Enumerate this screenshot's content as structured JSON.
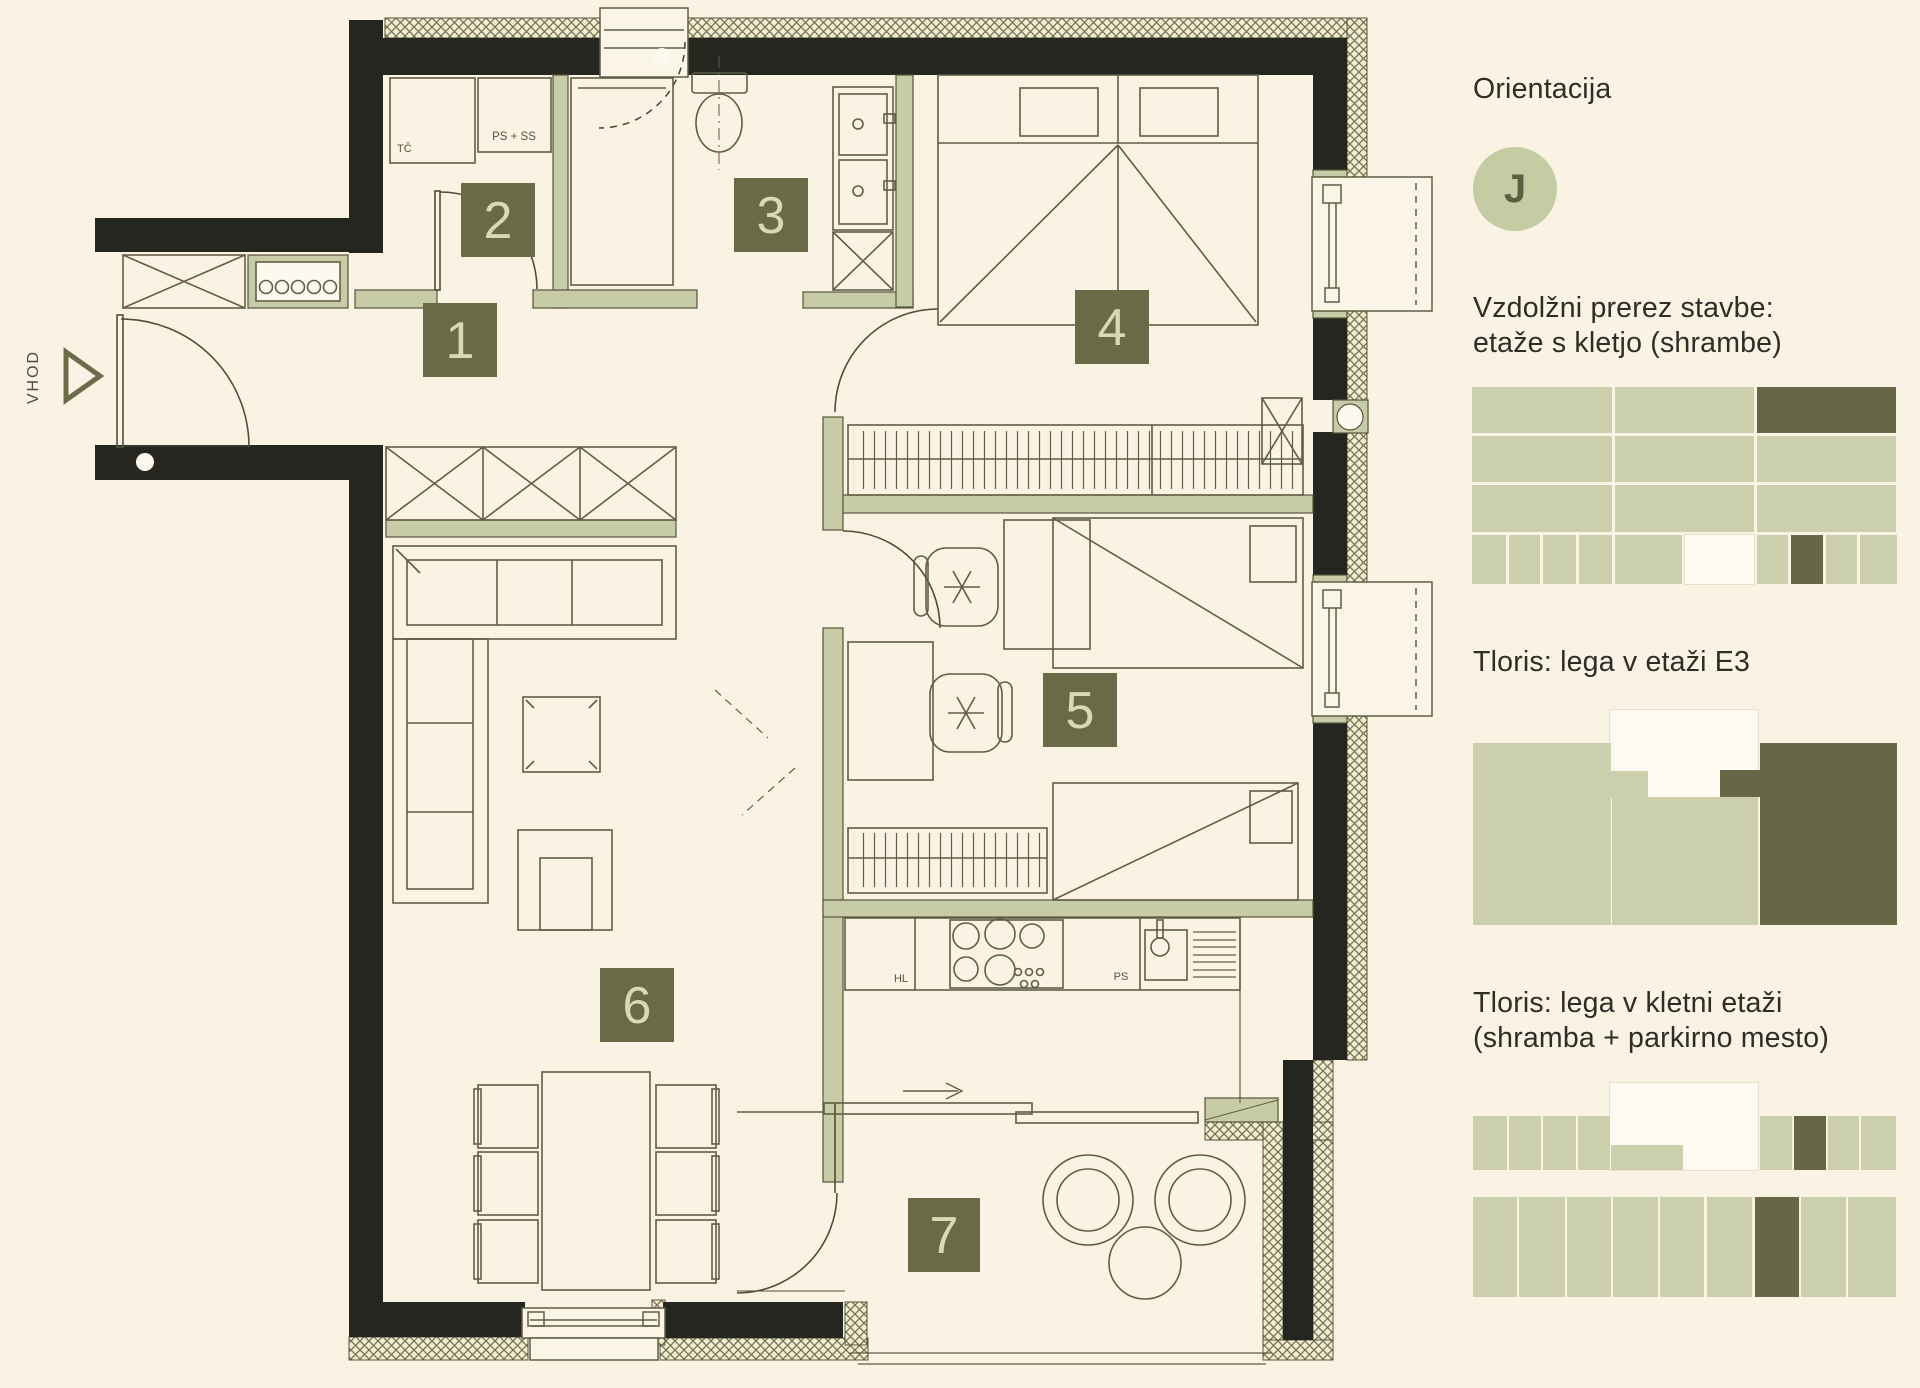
{
  "page": {
    "background": "#faf3e4",
    "colors": {
      "wall": "#262621",
      "line": "#5f5e44",
      "interior_wall": "#c8cca6",
      "badge_bg": "#696b46",
      "badge_text": "#d8dab6",
      "hatch_line": "#74744b",
      "text": "#2d2e28"
    }
  },
  "plan": {
    "entrance_label": "VHOD",
    "badges": [
      "1",
      "2",
      "3",
      "4",
      "5",
      "6",
      "7"
    ],
    "labels": {
      "tc": "TČ",
      "ps_ss": "PS + SS",
      "hl": "HL",
      "ps": "PS"
    }
  },
  "sidebar": {
    "orientation": {
      "title": "Orientacija",
      "value": "J",
      "circle_bg": "#c5cba3",
      "circle_text": "#596041"
    },
    "sections": [
      {
        "title": "Vzdolžni prerez stavbe:\netaže s kletjo (shrambe)"
      },
      {
        "title": "Tloris: lega v etaži E3"
      },
      {
        "title": "Tloris: lega v kletni etaži\n(shramba + parkirno mesto)"
      }
    ],
    "palette": {
      "L": "#cccfac",
      "D": "#666845",
      "W": "#fdfaf1"
    },
    "diagrams": {
      "section_grid": [
        {
          "x": 0,
          "y": 4,
          "w": 140,
          "h": 46,
          "c": "L"
        },
        {
          "x": 143,
          "y": 4,
          "w": 139,
          "h": 46,
          "c": "L"
        },
        {
          "x": 285,
          "y": 4,
          "w": 139,
          "h": 46,
          "c": "D"
        },
        {
          "x": 0,
          "y": 53,
          "w": 140,
          "h": 46,
          "c": "L"
        },
        {
          "x": 143,
          "y": 53,
          "w": 139,
          "h": 46,
          "c": "L"
        },
        {
          "x": 285,
          "y": 53,
          "w": 139,
          "h": 46,
          "c": "L"
        },
        {
          "x": 0,
          "y": 102,
          "w": 140,
          "h": 47,
          "c": "L"
        },
        {
          "x": 143,
          "y": 102,
          "w": 139,
          "h": 47,
          "c": "L"
        },
        {
          "x": 285,
          "y": 102,
          "w": 139,
          "h": 47,
          "c": "L"
        },
        {
          "x": 0,
          "y": 152,
          "w": 34,
          "h": 49,
          "c": "L"
        },
        {
          "x": 37,
          "y": 152,
          "w": 31,
          "h": 49,
          "c": "L"
        },
        {
          "x": 71,
          "y": 152,
          "w": 33,
          "h": 49,
          "c": "L"
        },
        {
          "x": 107,
          "y": 152,
          "w": 33,
          "h": 49,
          "c": "L"
        },
        {
          "x": 143,
          "y": 152,
          "w": 67,
          "h": 49,
          "c": "L"
        },
        {
          "x": 213,
          "y": 152,
          "w": 69,
          "h": 49,
          "c": "W"
        },
        {
          "x": 285,
          "y": 152,
          "w": 31,
          "h": 49,
          "c": "L"
        },
        {
          "x": 319,
          "y": 152,
          "w": 32,
          "h": 49,
          "c": "D"
        },
        {
          "x": 354,
          "y": 152,
          "w": 31,
          "h": 49,
          "c": "L"
        },
        {
          "x": 388,
          "y": 152,
          "w": 37,
          "h": 49,
          "c": "L"
        }
      ],
      "floor_e3": [
        {
          "x": 137,
          "y": 0,
          "w": 148,
          "h": 87,
          "c": "W"
        },
        {
          "x": 0,
          "y": 33,
          "w": 138,
          "h": 182,
          "c": "L"
        },
        {
          "x": 138,
          "y": 61,
          "w": 37,
          "h": 26,
          "c": "L"
        },
        {
          "x": 139,
          "y": 87,
          "w": 146,
          "h": 128,
          "c": "L"
        },
        {
          "x": 247,
          "y": 60,
          "w": 40,
          "h": 27,
          "c": "D"
        },
        {
          "x": 287,
          "y": 33,
          "w": 137,
          "h": 182,
          "c": "D"
        }
      ],
      "basement": [
        {
          "x": 137,
          "y": 0,
          "w": 148,
          "h": 87,
          "c": "W"
        },
        {
          "x": 0,
          "y": 33,
          "w": 34,
          "h": 54,
          "c": "L"
        },
        {
          "x": 36,
          "y": 33,
          "w": 32,
          "h": 54,
          "c": "L"
        },
        {
          "x": 70,
          "y": 33,
          "w": 33,
          "h": 54,
          "c": "L"
        },
        {
          "x": 105,
          "y": 33,
          "w": 32,
          "h": 54,
          "c": "L"
        },
        {
          "x": 138,
          "y": 62,
          "w": 72,
          "h": 25,
          "c": "L"
        },
        {
          "x": 287,
          "y": 33,
          "w": 32,
          "h": 54,
          "c": "L"
        },
        {
          "x": 321,
          "y": 33,
          "w": 32,
          "h": 54,
          "c": "D"
        },
        {
          "x": 355,
          "y": 33,
          "w": 31,
          "h": 54,
          "c": "L"
        },
        {
          "x": 388,
          "y": 33,
          "w": 35,
          "h": 54,
          "c": "L"
        },
        {
          "x": 0,
          "y": 114,
          "w": 44,
          "h": 100,
          "c": "L"
        },
        {
          "x": 46,
          "y": 114,
          "w": 46,
          "h": 100,
          "c": "L"
        },
        {
          "x": 94,
          "y": 114,
          "w": 44,
          "h": 100,
          "c": "L"
        },
        {
          "x": 140,
          "y": 114,
          "w": 45,
          "h": 100,
          "c": "L"
        },
        {
          "x": 187,
          "y": 114,
          "w": 44,
          "h": 100,
          "c": "L"
        },
        {
          "x": 234,
          "y": 114,
          "w": 45,
          "h": 100,
          "c": "L"
        },
        {
          "x": 282,
          "y": 114,
          "w": 44,
          "h": 100,
          "c": "D"
        },
        {
          "x": 328,
          "y": 114,
          "w": 45,
          "h": 100,
          "c": "L"
        },
        {
          "x": 375,
          "y": 114,
          "w": 48,
          "h": 100,
          "c": "L"
        }
      ]
    }
  }
}
